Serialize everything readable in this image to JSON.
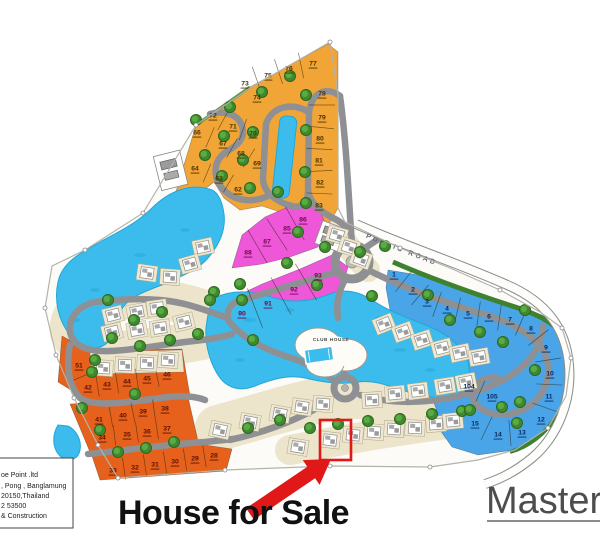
{
  "annotations": {
    "house_for_sale": "House for Sale",
    "master_label": "Master",
    "public_road": "PUBLIC ROAD",
    "club_house": "CLUB HOUSE"
  },
  "address_box": {
    "lines": [
      "oe Point .ltd",
      ", Pong , Banglamung",
      "20150,Thailand",
      "2 53500",
      "& Construction"
    ]
  },
  "colors": {
    "water": "#3bbcec",
    "water_dark": "#22a6d8",
    "road": "#8f9093",
    "public_road_fill": "#fdfdfb",
    "cream": "#ece4cb",
    "cream_pad": "#eee7d1",
    "site_fill": "#fcfbf7",
    "boundary": "#b3b3aa",
    "green_strip": "#3e8230",
    "tree_dark": "#2e661f",
    "tree_mid": "#3f8a2e",
    "tree_light": "#5cae47",
    "highlight_red": "#e01818",
    "text_black": "#111111",
    "master_gray": "#4d4d4d"
  },
  "map": {
    "lot_groups": [
      {
        "name": "yellow",
        "color": "#f2a537",
        "text_color": "#4a3200",
        "lots": [
          {
            "n": "77",
            "x": 313,
            "y": 63
          },
          {
            "n": "76",
            "x": 289,
            "y": 68
          },
          {
            "n": "75",
            "x": 268,
            "y": 75
          },
          {
            "n": "73",
            "x": 245,
            "y": 83
          },
          {
            "n": "74",
            "x": 257,
            "y": 97
          },
          {
            "n": "78",
            "x": 322,
            "y": 93
          },
          {
            "n": "79",
            "x": 322,
            "y": 117
          },
          {
            "n": "80",
            "x": 320,
            "y": 138
          },
          {
            "n": "81",
            "x": 319,
            "y": 160
          },
          {
            "n": "82",
            "x": 320,
            "y": 182
          },
          {
            "n": "83",
            "x": 319,
            "y": 205
          },
          {
            "n": "72",
            "x": 213,
            "y": 115
          },
          {
            "n": "71",
            "x": 233,
            "y": 126
          },
          {
            "n": "70",
            "x": 253,
            "y": 133
          },
          {
            "n": "66",
            "x": 197,
            "y": 132
          },
          {
            "n": "67",
            "x": 223,
            "y": 143
          },
          {
            "n": "68",
            "x": 241,
            "y": 153
          },
          {
            "n": "69",
            "x": 257,
            "y": 163
          },
          {
            "n": "64",
            "x": 195,
            "y": 168
          },
          {
            "n": "63",
            "x": 219,
            "y": 178
          },
          {
            "n": "62",
            "x": 238,
            "y": 189
          }
        ]
      },
      {
        "name": "orange",
        "color": "#e6621c",
        "text_color": "#5c1000",
        "lots": [
          {
            "n": "51",
            "x": 79,
            "y": 365
          },
          {
            "n": "42",
            "x": 88,
            "y": 387
          },
          {
            "n": "43",
            "x": 107,
            "y": 384
          },
          {
            "n": "44",
            "x": 127,
            "y": 381
          },
          {
            "n": "45",
            "x": 147,
            "y": 378
          },
          {
            "n": "46",
            "x": 167,
            "y": 374
          },
          {
            "n": "41",
            "x": 99,
            "y": 419
          },
          {
            "n": "40",
            "x": 123,
            "y": 415
          },
          {
            "n": "39",
            "x": 143,
            "y": 411
          },
          {
            "n": "38",
            "x": 165,
            "y": 408
          },
          {
            "n": "34",
            "x": 102,
            "y": 437
          },
          {
            "n": "35",
            "x": 127,
            "y": 434
          },
          {
            "n": "36",
            "x": 147,
            "y": 431
          },
          {
            "n": "37",
            "x": 167,
            "y": 428
          },
          {
            "n": "33",
            "x": 113,
            "y": 470
          },
          {
            "n": "32",
            "x": 135,
            "y": 467
          },
          {
            "n": "31",
            "x": 155,
            "y": 464
          },
          {
            "n": "30",
            "x": 175,
            "y": 461
          },
          {
            "n": "29",
            "x": 195,
            "y": 458
          },
          {
            "n": "28",
            "x": 214,
            "y": 455
          }
        ]
      },
      {
        "name": "pink",
        "color": "#ee58d8",
        "text_color": "#70084e",
        "lots": [
          {
            "n": "85",
            "x": 287,
            "y": 228
          },
          {
            "n": "86",
            "x": 303,
            "y": 219
          },
          {
            "n": "87",
            "x": 267,
            "y": 241
          },
          {
            "n": "88",
            "x": 248,
            "y": 252
          },
          {
            "n": "90",
            "x": 242,
            "y": 313
          },
          {
            "n": "91",
            "x": 268,
            "y": 303
          },
          {
            "n": "92",
            "x": 294,
            "y": 289
          },
          {
            "n": "93",
            "x": 318,
            "y": 275
          }
        ]
      },
      {
        "name": "blue",
        "color": "#4aa4e8",
        "text_color": "#0a2a60",
        "lots": [
          {
            "n": "1",
            "x": 394,
            "y": 274
          },
          {
            "n": "2",
            "x": 413,
            "y": 289
          },
          {
            "n": "3",
            "x": 427,
            "y": 301
          },
          {
            "n": "4",
            "x": 447,
            "y": 308
          },
          {
            "n": "5",
            "x": 468,
            "y": 313
          },
          {
            "n": "6",
            "x": 489,
            "y": 316
          },
          {
            "n": "7",
            "x": 510,
            "y": 319
          },
          {
            "n": "8",
            "x": 531,
            "y": 328
          },
          {
            "n": "9",
            "x": 546,
            "y": 347
          },
          {
            "n": "10",
            "x": 550,
            "y": 373
          },
          {
            "n": "11",
            "x": 549,
            "y": 396
          },
          {
            "n": "12",
            "x": 541,
            "y": 419
          },
          {
            "n": "104",
            "x": 469,
            "y": 386
          },
          {
            "n": "105",
            "x": 492,
            "y": 396
          },
          {
            "n": "15",
            "x": 475,
            "y": 423
          },
          {
            "n": "14",
            "x": 498,
            "y": 434
          },
          {
            "n": "13",
            "x": 522,
            "y": 432
          }
        ]
      }
    ],
    "divider_rows": [
      {
        "lots": [
          "73",
          "75",
          "76",
          "77"
        ],
        "depth": 26
      },
      {
        "lots": [
          "72",
          "71",
          "70"
        ],
        "depth": 22
      },
      {
        "lots": [
          "66",
          "67",
          "68",
          "69"
        ],
        "depth": 22
      },
      {
        "lots": [
          "64",
          "63",
          "62"
        ],
        "depth": 20
      },
      {
        "lots": [
          "78",
          "79",
          "80",
          "81",
          "82",
          "83"
        ],
        "depth": 26
      },
      {
        "lots": [
          "51",
          "42",
          "43",
          "44",
          "45",
          "46"
        ],
        "depth": 22
      },
      {
        "lots": [
          "41",
          "40",
          "39",
          "38"
        ],
        "depth": 20
      },
      {
        "lots": [
          "34",
          "35",
          "36",
          "37"
        ],
        "depth": 20
      },
      {
        "lots": [
          "33",
          "32",
          "31",
          "30",
          "29",
          "28"
        ],
        "depth": 22
      },
      {
        "lots": [
          "88",
          "87",
          "85",
          "86"
        ],
        "depth": 38
      },
      {
        "lots": [
          "90",
          "91",
          "92",
          "93"
        ],
        "depth": 42
      },
      {
        "lots": [
          "1",
          "2",
          "3",
          "4",
          "5",
          "6",
          "7",
          "8"
        ],
        "depth": 26
      },
      {
        "lots": [
          "8",
          "9",
          "10",
          "11",
          "12"
        ],
        "depth": 26
      },
      {
        "lots": [
          "104",
          "105"
        ],
        "depth": 22
      },
      {
        "lots": [
          "15",
          "14",
          "13"
        ],
        "depth": 26
      }
    ],
    "houses": [
      [
        147,
        273,
        8
      ],
      [
        170,
        277,
        4
      ],
      [
        113,
        315,
        -14
      ],
      [
        137,
        312,
        -10
      ],
      [
        157,
        308,
        -8
      ],
      [
        112,
        332,
        -14
      ],
      [
        137,
        330,
        -10
      ],
      [
        160,
        328,
        -8
      ],
      [
        184,
        322,
        -14
      ],
      [
        103,
        368,
        4
      ],
      [
        125,
        365,
        3
      ],
      [
        147,
        363,
        3
      ],
      [
        168,
        360,
        4
      ],
      [
        220,
        430,
        12
      ],
      [
        250,
        422,
        10
      ],
      [
        280,
        414,
        10
      ],
      [
        302,
        407,
        8
      ],
      [
        323,
        404,
        5
      ],
      [
        372,
        400,
        -4
      ],
      [
        395,
        394,
        -6
      ],
      [
        418,
        391,
        -7
      ],
      [
        445,
        386,
        -9
      ],
      [
        466,
        382,
        -11
      ],
      [
        298,
        447,
        9
      ],
      [
        330,
        440,
        7
      ],
      [
        353,
        435,
        6
      ],
      [
        374,
        432,
        5
      ],
      [
        394,
        429,
        4
      ],
      [
        415,
        428,
        3
      ],
      [
        436,
        424,
        -4
      ],
      [
        453,
        421,
        -6
      ],
      [
        384,
        324,
        -22
      ],
      [
        403,
        332,
        -20
      ],
      [
        422,
        340,
        -18
      ],
      [
        442,
        348,
        -15
      ],
      [
        460,
        353,
        -12
      ],
      [
        479,
        357,
        -10
      ],
      [
        337,
        235,
        16
      ],
      [
        349,
        247,
        18
      ],
      [
        361,
        259,
        20
      ],
      [
        203,
        247,
        -12
      ],
      [
        190,
        264,
        -16
      ]
    ],
    "trees": [
      [
        196,
        120
      ],
      [
        230,
        107
      ],
      [
        262,
        92
      ],
      [
        290,
        76
      ],
      [
        306,
        95
      ],
      [
        306,
        130
      ],
      [
        305,
        172
      ],
      [
        306,
        203
      ],
      [
        253,
        132
      ],
      [
        224,
        136
      ],
      [
        205,
        155
      ],
      [
        243,
        160
      ],
      [
        222,
        176
      ],
      [
        250,
        188
      ],
      [
        278,
        192
      ],
      [
        325,
        247
      ],
      [
        108,
        300
      ],
      [
        134,
        320
      ],
      [
        162,
        312
      ],
      [
        214,
        292
      ],
      [
        240,
        284
      ],
      [
        112,
        338
      ],
      [
        140,
        346
      ],
      [
        170,
        340
      ],
      [
        198,
        334
      ],
      [
        95,
        360
      ],
      [
        92,
        372
      ],
      [
        82,
        408
      ],
      [
        100,
        430
      ],
      [
        118,
        452
      ],
      [
        146,
        448
      ],
      [
        174,
        442
      ],
      [
        135,
        394
      ],
      [
        248,
        428
      ],
      [
        280,
        420
      ],
      [
        310,
        428
      ],
      [
        338,
        424
      ],
      [
        368,
        421
      ],
      [
        400,
        419
      ],
      [
        432,
        414
      ],
      [
        462,
        411
      ],
      [
        298,
        232
      ],
      [
        287,
        263
      ],
      [
        317,
        285
      ],
      [
        242,
        300
      ],
      [
        253,
        340
      ],
      [
        210,
        300
      ],
      [
        428,
        295
      ],
      [
        450,
        320
      ],
      [
        480,
        332
      ],
      [
        503,
        342
      ],
      [
        525,
        310
      ],
      [
        535,
        370
      ],
      [
        520,
        402
      ],
      [
        502,
        407
      ],
      [
        470,
        410
      ],
      [
        517,
        423
      ],
      [
        372,
        296
      ],
      [
        360,
        252
      ],
      [
        385,
        246
      ]
    ]
  }
}
